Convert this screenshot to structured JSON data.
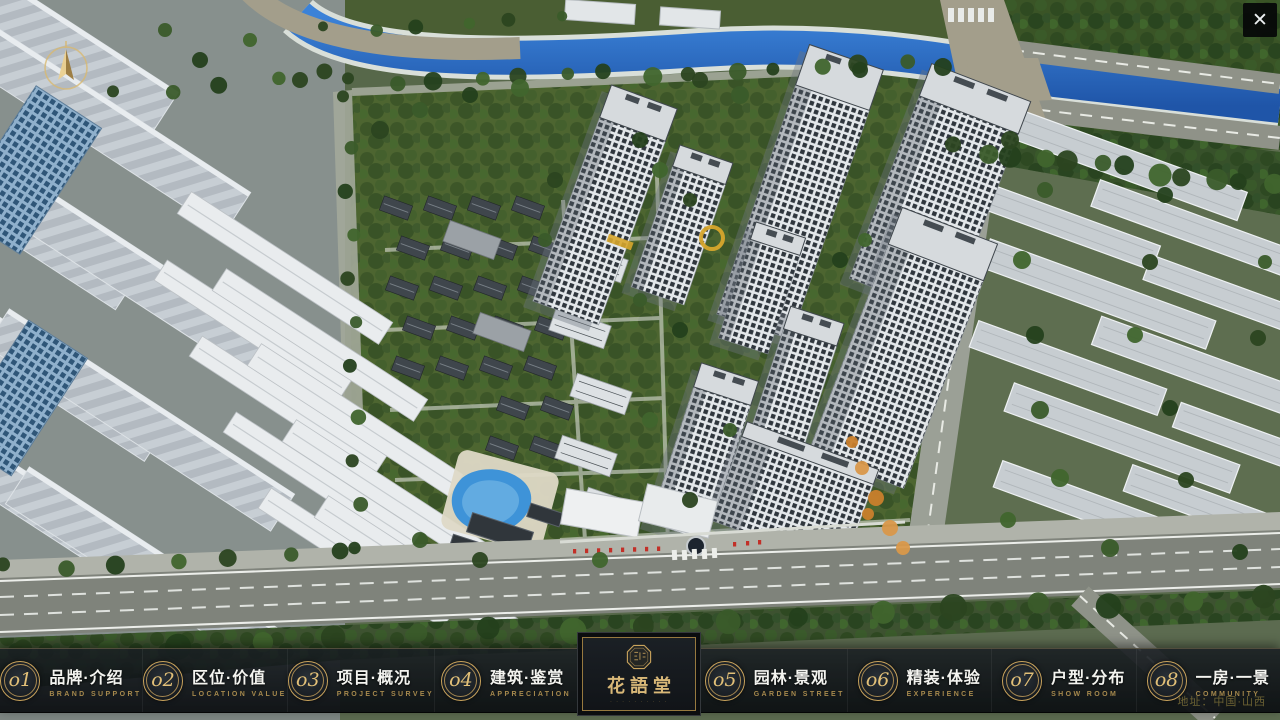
{
  "ui": {
    "close_glyph": "✕"
  },
  "navbar": {
    "items": [
      {
        "num": "o1",
        "zh": "品牌·介绍",
        "en": "BRAND SUPPORT"
      },
      {
        "num": "o2",
        "zh": "区位·价值",
        "en": "LOCATION VALUE"
      },
      {
        "num": "o3",
        "zh": "项目·概况",
        "en": "PROJECT SURVEY"
      },
      {
        "num": "o4",
        "zh": "建筑·鉴赏",
        "en": "APPRECIATION"
      },
      {
        "num": "o5",
        "zh": "园林·景观",
        "en": "GARDEN STREET"
      },
      {
        "num": "o6",
        "zh": "精装·体验",
        "en": "EXPERIENCE"
      },
      {
        "num": "o7",
        "zh": "户型·分布",
        "en": "SHOW ROOM"
      },
      {
        "num": "o8",
        "zh": "一房·一景",
        "en": "COMMUNITY"
      }
    ]
  },
  "logo": {
    "title": "花語堂",
    "tagline": "· · · · · · · · · ·"
  },
  "footer": {
    "address": "地址：中国·山西"
  },
  "colors": {
    "gold": "#c9a35c",
    "gold_bright": "#e2c078",
    "nav_bg": "#12161a",
    "river_blue": "#2a6cc5",
    "flag_red": "#c23028"
  }
}
